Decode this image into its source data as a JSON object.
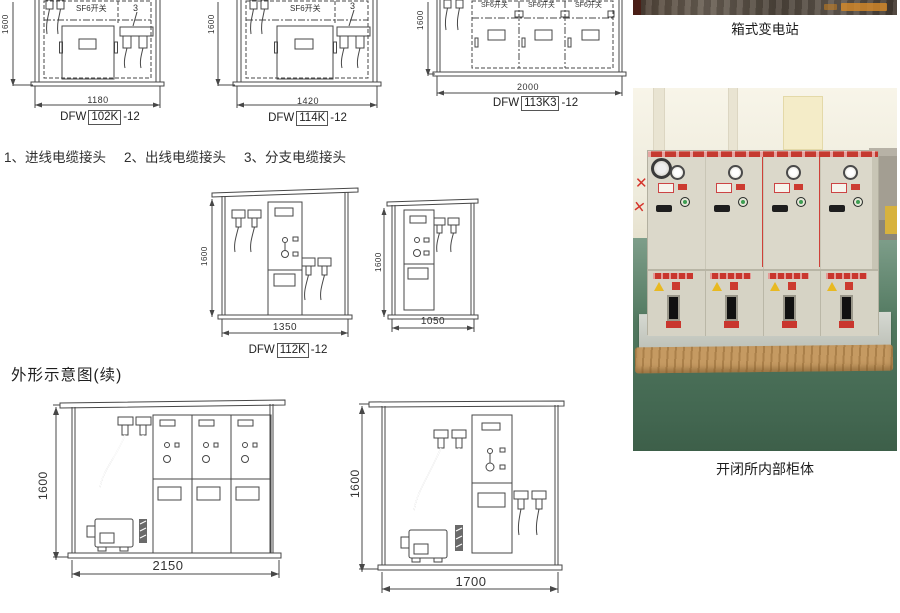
{
  "legend": {
    "items": [
      "1、进线电缆接头",
      "2、出线电缆接头",
      "3、分支电缆接头"
    ]
  },
  "section": {
    "heading_continued": "外形示意图(续)"
  },
  "drawings": {
    "d1": {
      "model_prefix": "DFW",
      "model_code": "102K",
      "model_suffix": "-12",
      "width": "1180",
      "height": "1600",
      "unit": "SF6开关",
      "callout": "3"
    },
    "d2": {
      "model_prefix": "DFW",
      "model_code": "114K",
      "model_suffix": "-12",
      "width": "1420",
      "height": "1600",
      "unit": "SF6开关",
      "callout": "3"
    },
    "d3": {
      "model_prefix": "DFW",
      "model_code": "113K3",
      "model_suffix": "-12",
      "width": "2000",
      "height": "1600",
      "units": [
        "SF6开关",
        "SF6开关",
        "SF6开关"
      ]
    },
    "m1": {
      "model_prefix": "DFW",
      "model_code": "112K",
      "model_suffix": "-12",
      "width": "1350",
      "height": "1600"
    },
    "m2": {
      "width": "1050",
      "height": "1600"
    },
    "b1": {
      "width": "2150",
      "height": "1600"
    },
    "b2": {
      "width": "1700",
      "height": "1600"
    }
  },
  "photos": {
    "top_caption": "箱式变电站",
    "bottom_caption": "开闭所内部柜体"
  },
  "colors": {
    "line": "#474747",
    "accent_red": "#c9362e",
    "cabinet_beige": "#dbd8ca",
    "floor_green": "#51785f",
    "pallet_wood": "#c59a62"
  }
}
